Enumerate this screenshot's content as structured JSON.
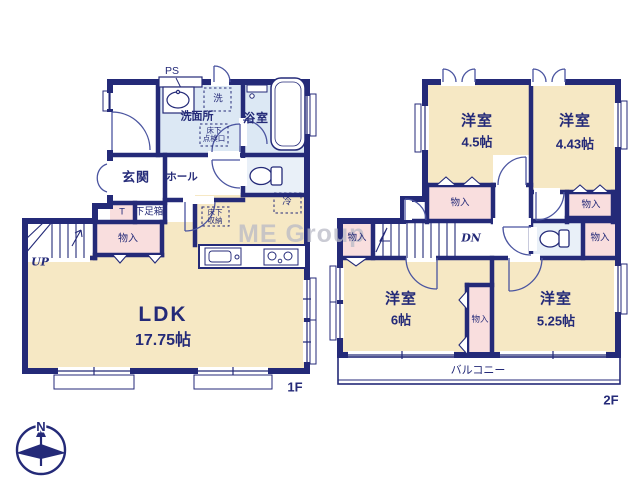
{
  "palette": {
    "wall_navy": "#242a78",
    "room_cream": "#f6e8c4",
    "closet_pink": "#f9dede",
    "wet_blue": "#dce8f4",
    "toilet_blue": "#e9f0f8",
    "label_navy": "#242a78",
    "watermark_gray": "#b9bac6"
  },
  "watermark": "ME Group",
  "compass": {
    "north_label": "N"
  },
  "floor1": {
    "floor_label": "1F",
    "ps_label": "PS",
    "washer_label": "洗",
    "washroom_label": "洗面所",
    "hatch_line1": "床下",
    "hatch_line2": "点検口",
    "bathroom_label": "浴室",
    "entrance_label": "玄関",
    "hall_label": "ホール",
    "t_label": "T",
    "shoe_cabinet_label": "下足箱",
    "closet_label": "物入",
    "stairs_label": "UP",
    "underfloor_line1": "床下",
    "underfloor_line2": "収納",
    "fridge_label": "冷",
    "ldk_label": "LDK",
    "ldk_size": "17.75帖"
  },
  "floor2": {
    "floor_label": "2F",
    "room_nw": {
      "name": "洋室",
      "size": "4.5帖"
    },
    "room_ne": {
      "name": "洋室",
      "size": "4.43帖"
    },
    "room_sw": {
      "name": "洋室",
      "size": "6帖"
    },
    "room_se": {
      "name": "洋室",
      "size": "5.25帖"
    },
    "closet_under_nw": "物入",
    "closet_under_ne": "物入",
    "closet_west": "物入",
    "closet_east": "物入",
    "closet_center": "物入",
    "stairs_label": "DN",
    "balcony_label": "バルコニー"
  }
}
